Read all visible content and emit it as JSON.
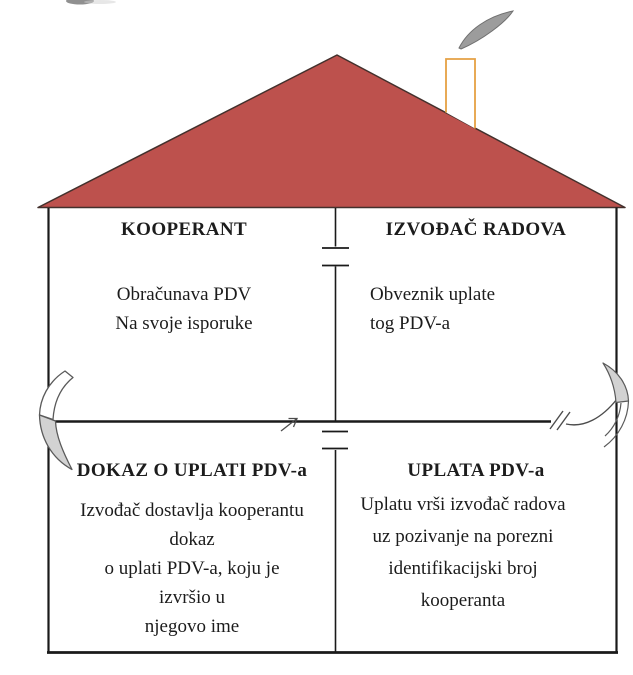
{
  "house": {
    "quadrants": {
      "top_left": {
        "header": "KOOPERANT",
        "lines": [
          "Obračunava PDV",
          "Na svoje isporuke"
        ]
      },
      "top_right": {
        "header": "IZVOĐAČ RADOVA",
        "lines": [
          "Obveznik uplate",
          "tog PDV-a"
        ]
      },
      "bottom_left": {
        "header": "DOKAZ O UPLATI PDV-a",
        "lines": [
          "Izvođač dostavlja kooperantu",
          "dokaz",
          "o uplati PDV-a, koju je",
          "izvršio u",
          "njegovo ime"
        ]
      },
      "bottom_right": {
        "header": "UPLATA PDV-a",
        "lines": [
          "Uplatu vrši izvođač radova",
          "uz pozivanje na porezni",
          "identifikacijski broj",
          "kooperanta"
        ]
      }
    },
    "colors": {
      "roof-fill": "#bd514d",
      "roof-outline": "#43302c",
      "chimney-outline": "#e5a144",
      "smoke-fill": "#9c9c9c",
      "smoke-outline": "#6f6f6f",
      "line-color": "#1a1a1a",
      "ribbon-fill": "#d2d2d2",
      "ribbon-stroke": "#5a5a5a",
      "arrow-color": "#4c4c4c"
    }
  }
}
